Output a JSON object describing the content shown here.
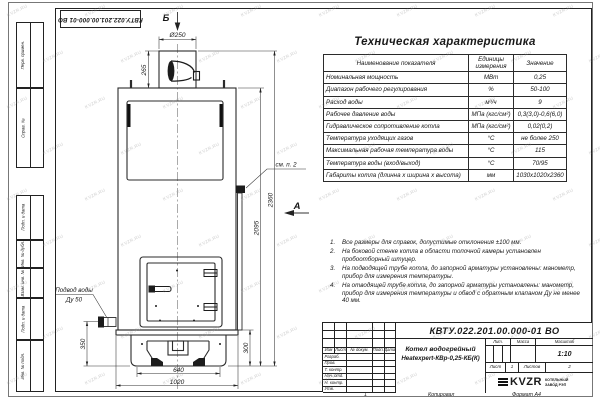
{
  "watermark": "KVZR.RU",
  "frame": {
    "top_doc_number": "КВТУ.022.201.00.000-01 ВО",
    "side_labels": [
      "Перв. примен.",
      "Справ. №",
      "Подп. и дата",
      "Инв. № дубл.",
      "Взам. инв. №",
      "Подп. и дата",
      "Инв. № подл."
    ],
    "bottom_mark": "1",
    "copied_label": "Копировал",
    "format_label": "Формат А4"
  },
  "drawing": {
    "views": {
      "b": "Б",
      "a": "А"
    },
    "dims": {
      "chimney_diameter": "Ø250",
      "chimney_height": "265",
      "total_height": "2360",
      "body_height": "2095",
      "inlet_height": "350",
      "base_height": "300",
      "base_width": "640",
      "overall_width": "1020"
    },
    "callouts": {
      "see_note": "см. п. 2",
      "water_inlet_line1": "Подвод воды",
      "water_inlet_line2": "Ду 50"
    }
  },
  "spec_table": {
    "title": "Техническая характеристика",
    "headers": [
      "Наименование показателя",
      "Единицы измерения",
      "Значение"
    ],
    "rows": [
      [
        "Номинальная мощность",
        "МВт",
        "0,25"
      ],
      [
        "Диапазон рабочего регулирования",
        "%",
        "50-100"
      ],
      [
        "Расход воды",
        "м³/ч",
        "9"
      ],
      [
        "Рабочее давление воды",
        "МПа (кгс/см²)",
        "0,3(3,0)-0,6(6,0)"
      ],
      [
        "Гидравлическое сопротивление котла",
        "МПа (кгс/см²)",
        "0,02(0,2)"
      ],
      [
        "Температура уходящих газов",
        "°С",
        "не более 250"
      ],
      [
        "Максимальная рабочая температура воды",
        "°С",
        "115"
      ],
      [
        "Температура воды (вход/выход)",
        "°С",
        "70/95"
      ],
      [
        "Габариты котла (длинна х ширина х высота)",
        "мм",
        "1030х1020х2360"
      ]
    ]
  },
  "notes": [
    "Все размеры для справок, допустимые отклонения ±100 мм.",
    "На боковой стенке котла в области топочной камеры установлен пробоотборный штуцер.",
    "На подводящей трубе котла, до запорной арматуры установлены: манометр, прибор для измерения температуры.",
    "На отводящей трубе котла, до запорной арматуры установлены: манометр, прибор для измерения температуры и обвод с обратным клапаном Ду не менее 40 мм."
  ],
  "title_block": {
    "doc_number": "КВТУ.022.201.00.000-01 ВО",
    "product_name_1": "Котел водогрейный",
    "product_name_2": "Heatexpert-КВр-0,25-КБ(К)",
    "col_headers": [
      "Изм",
      "Лист",
      "№ докум.",
      "Подп.",
      "Дата"
    ],
    "row_labels": [
      "Разраб.",
      "Пров.",
      "Т. контр.",
      "Нач. отд.",
      "Н. контр.",
      "Утв."
    ],
    "lit_label": "Лит.",
    "mass_label": "Масса",
    "scale_label": "Масштаб",
    "scale_value": "1:10",
    "sheet_label": "Лист",
    "sheet_value": "1",
    "sheets_label": "Листов",
    "sheets_value": "2",
    "logo_text": "KVZR",
    "logo_sub_1": "КОТЕЛЬНЫЙ",
    "logo_sub_2": "ЗАВОД РЭП"
  }
}
